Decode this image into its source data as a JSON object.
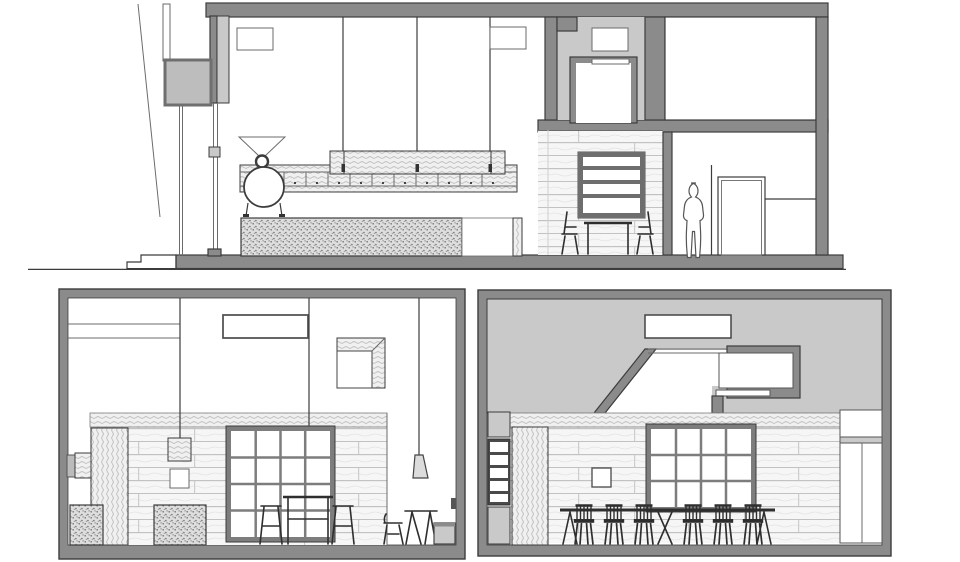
{
  "document": {
    "kind": "architectural-section-drawing",
    "text_content": "none"
  },
  "colors": {
    "section_gray": "#8b8b8b",
    "beyond_gray": "#c9c9c9",
    "panel_frame_gray": "#8b8b8b",
    "line_dark": "#3c3c3c",
    "line_mid": "#6b6b6b",
    "furniture_dark": "#2e2e2e",
    "sign_gray": "#bdbdbd",
    "mullion_gray": "#7d7d7d",
    "background": "#ffffff"
  },
  "panels": [
    {
      "id": "top-section",
      "icons": [
        "hanging-sign-icon",
        "coffee-roaster-icon",
        "suspended-shelf-icon",
        "bar-counter-icon",
        "wall-shelving-icon",
        "table-and-chairs-icon",
        "stair-core-icon",
        "person-silhouette-icon",
        "door-icon"
      ]
    },
    {
      "id": "bottom-left-section",
      "icons": [
        "ceiling-light-icon",
        "pendant-cube-lamp-icon",
        "cone-pendant-lamp-icon",
        "shadow-box-art-icon",
        "grid-window-icon",
        "brick-wall-icon",
        "planter-icon",
        "high-table-icon",
        "stool-icon",
        "chair-icon",
        "trestle-table-icon",
        "bench-icon"
      ]
    },
    {
      "id": "bottom-right-section",
      "icons": [
        "ceiling-light-icon",
        "stair-void-icon",
        "wall-shelf-unit-icon",
        "grid-window-icon",
        "brick-wall-icon",
        "communal-table-icon",
        "spindle-chair-icon",
        "door-icon"
      ]
    }
  ]
}
